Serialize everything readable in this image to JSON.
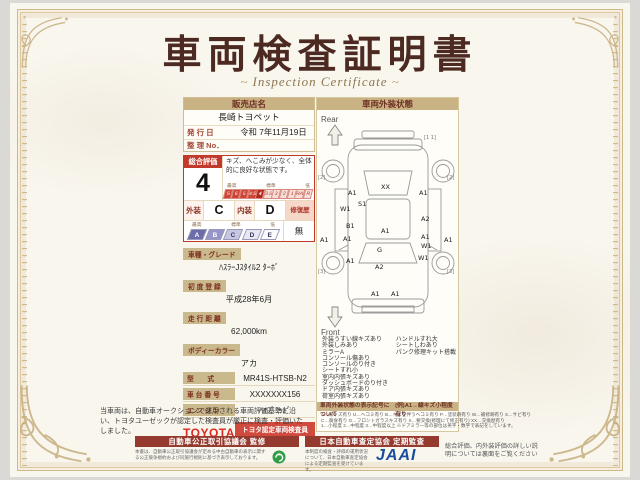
{
  "page": {
    "title": "車両検査証明書",
    "subtitle": "Inspection Certificate"
  },
  "left": {
    "dealer_header": "販売店名",
    "dealer_name": "長崎トヨペット",
    "issue_label": "発 行 日",
    "issue_value": "令和 7年11月19日",
    "ref_label": "整 理 No．",
    "ref_value": "",
    "rating": {
      "header": "総合評価",
      "value": "4",
      "comment": "キズ、へこみが少なく、全体的に良好な状態です。",
      "scale_high": "最高",
      "scale_mid": "標準",
      "scale_low": "低",
      "scale": [
        "S",
        "6",
        "5",
        "4.5",
        "4",
        "3.5",
        "3",
        "2",
        "1",
        "RA",
        "R"
      ],
      "scale_selected": "4",
      "exterior_label": "外装",
      "exterior_value": "C",
      "interior_label": "内装",
      "interior_value": "D",
      "repair_label": "修復歴",
      "repair_value": "無",
      "grades": [
        "A",
        "B",
        "C",
        "D",
        "E"
      ]
    },
    "fields_stacked": [
      {
        "label": "車種・グレード",
        "value": "ﾊｽﾗｰJｽﾀｲﾙ2 ﾀｰﾎﾞ"
      },
      {
        "label": "初 度 登 録",
        "value": "平成28年6月"
      },
      {
        "label": "走 行 距 離",
        "value": "62,000km"
      },
      {
        "label": "ボディーカラー",
        "value": "アカ"
      }
    ],
    "fields_inline": [
      {
        "label": "型　　式",
        "value": "MR41S-HTSB-N2"
      },
      {
        "label": "車 台 番 号",
        "value": "XXXXXXX156"
      },
      {
        "label": "エ ン ジ ン",
        "value": "ﾊｲﾌﾞﾘｯﾄﾞ"
      }
    ],
    "toyota_logo": "TOYOTA",
    "inspector_badge": "トヨタ認定車両検査員",
    "inspector_id": "XXXXXX"
  },
  "right": {
    "header": "車両外装状態",
    "rear_label": "Rear",
    "front_label": "Front",
    "markers": [
      {
        "x": 63,
        "y": 78,
        "t": "XX"
      },
      {
        "x": 30,
        "y": 84,
        "t": "A1"
      },
      {
        "x": 101,
        "y": 84,
        "t": "A1"
      },
      {
        "x": 22,
        "y": 100,
        "t": "W1"
      },
      {
        "x": 40,
        "y": 95,
        "t": "S1"
      },
      {
        "x": 103,
        "y": 110,
        "t": "A2"
      },
      {
        "x": 28,
        "y": 117,
        "t": "B1"
      },
      {
        "x": 63,
        "y": 122,
        "t": "A1"
      },
      {
        "x": 25,
        "y": 130,
        "t": "A1"
      },
      {
        "x": 103,
        "y": 128,
        "t": "A1"
      },
      {
        "x": 2,
        "y": 131,
        "t": "A1"
      },
      {
        "x": 126,
        "y": 131,
        "t": "A1"
      },
      {
        "x": 103,
        "y": 137,
        "t": "W1"
      },
      {
        "x": 59,
        "y": 141,
        "t": "G"
      },
      {
        "x": 28,
        "y": 152,
        "t": "A1"
      },
      {
        "x": 100,
        "y": 149,
        "t": "W1"
      },
      {
        "x": 57,
        "y": 158,
        "t": "A2"
      },
      {
        "x": 53,
        "y": 185,
        "t": "A1"
      },
      {
        "x": 73,
        "y": 185,
        "t": "A1"
      }
    ],
    "wheel_marks": [
      {
        "x": 106,
        "y": 28,
        "t": "[1 1]"
      },
      {
        "x": 0,
        "y": 68,
        "t": "[2]"
      },
      {
        "x": 129,
        "y": 68,
        "t": "[2]"
      },
      {
        "x": 0,
        "y": 162,
        "t": "[3]"
      },
      {
        "x": 129,
        "y": 162,
        "t": "[3]"
      }
    ],
    "notes_col1": [
      "外装うすい線キズあり",
      "外装しみあり",
      "ミラーA",
      "コンソール傷あり",
      "コンソールのり付き",
      "シートすれ小",
      "室内内張キズあり",
      "ダッシュボードのり付き",
      "ドア内張キズあり",
      "荷室内張キズあり"
    ],
    "notes_col2": [
      "ハンドルすれ大",
      "シートしわあり",
      "パンク修理キット搭載"
    ],
    "legend_title": "車両外装状態の表示記号について",
    "legend_example": "(例)A1→線キズ小程度有り",
    "legend_lines": [
      "A…線キズ有り U…ヘコミ有り B…キズを伴うヘコミ有り P…塗装跡有り W…補修跡有り S…サビ有り",
      "C…腐食有り G…フロントガラスキズ有り X…要交換(修理にて修正有り) XX…交換歴有り",
      "1…小程度 2…中程度 3…中程度以上 ※ドアミラー等の部位は英字・数字で表記をしています。"
    ]
  },
  "footer": {
    "disclaimer": "当車両は、自動車オークションで運用される車両評価基準に沿い、トヨタユーゼックが認定した検査員が厳正に検査・評価いたしました。",
    "fair_bar": "自動車公正取引協議会 監修",
    "fair_note": "本書は、自動車公正取引協議会が定める中古自動車の表示に関する公正競争規約および同施行規則に基づき表示しております。",
    "assessor_bar": "日本自動車査定協会 定期監査",
    "assessor_note": "本制度の検査・評価の運用状況について、日本自動車査定協会による定期監査を受けています。",
    "jaai_logo": "JAAI",
    "back_note": "総合評価、内外装評価の詳しい説明については裏面をご覧ください"
  }
}
